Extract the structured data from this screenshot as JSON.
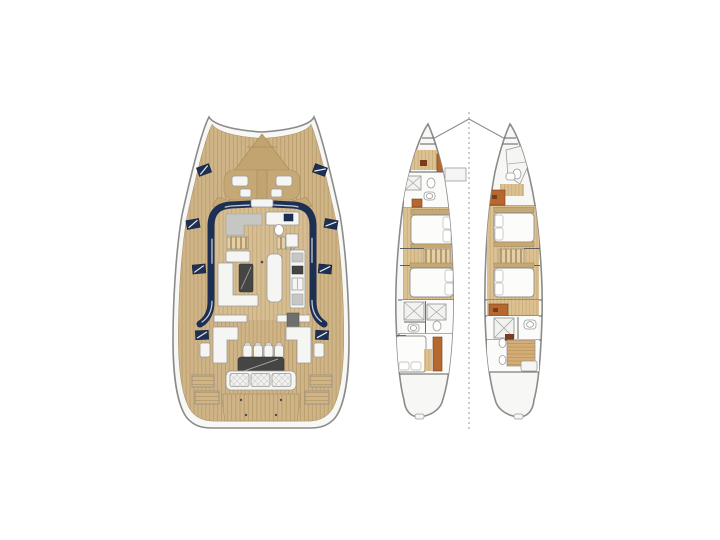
{
  "palette": {
    "page-bg": "#ffffff",
    "hull-fill": "#f7f7f5",
    "hull-stroke": "#8b8b89",
    "teak": "#cfb487",
    "teak-line": "#b69967",
    "teak-dark": "#c2a471",
    "salon-floor": "#d6bd92",
    "salon-floor-line": "#c0a775",
    "navy": "#1d2f52",
    "white-furniture": "#f5f5f3",
    "furniture-stroke": "#9b9b99",
    "gray-furniture": "#c6c6c2",
    "dark-table": "#454543",
    "wood-floor": "#dcc192",
    "wood-floor-line": "#c6a873",
    "wood-accent": "#b5692f",
    "wood-accent-dark": "#7a3c1d",
    "stair-light": "#e3d0a8",
    "stair-dark": "#b79a6a",
    "wall": "#5f5f5d",
    "centerline": "#9a9a98",
    "cushion-hatch": "#c9c9c7",
    "bed-stroke": "#8f8f8d",
    "tan-trim": "#c6a877",
    "tan-trim-line": "#a98c5c",
    "berth-wood": "#d3ac76",
    "berth-wood-line": "#b9915b",
    "grill-gray": "#6f6f6d"
  },
  "diagram": {
    "type": "floorplan",
    "subject": "catamaran-yacht-deck-plans",
    "views": [
      {
        "id": "main-deck-plan",
        "features": [
          "teak-deck",
          "bow-lounge-seating",
          "deck-hatches",
          "salon-window-band",
          "nav-desk",
          "galley-counters",
          "galley-sink",
          "salon-sofa",
          "salon-table",
          "galley-island",
          "companionway-stairs",
          "cockpit-settees",
          "cockpit-chairs",
          "cockpit-table",
          "aft-bench",
          "swim-platform",
          "transom-steps"
        ]
      },
      {
        "id": "lower-deck-plan",
        "features": [
          "dashed-centerline",
          "port-hull",
          "starboard-hull",
          "bow-lockers",
          "forepeak-berths",
          "bathrooms",
          "shower-trays",
          "toilets",
          "double-beds",
          "pillows",
          "hull-stairways",
          "wardrobes",
          "aft-cabins"
        ]
      }
    ]
  }
}
